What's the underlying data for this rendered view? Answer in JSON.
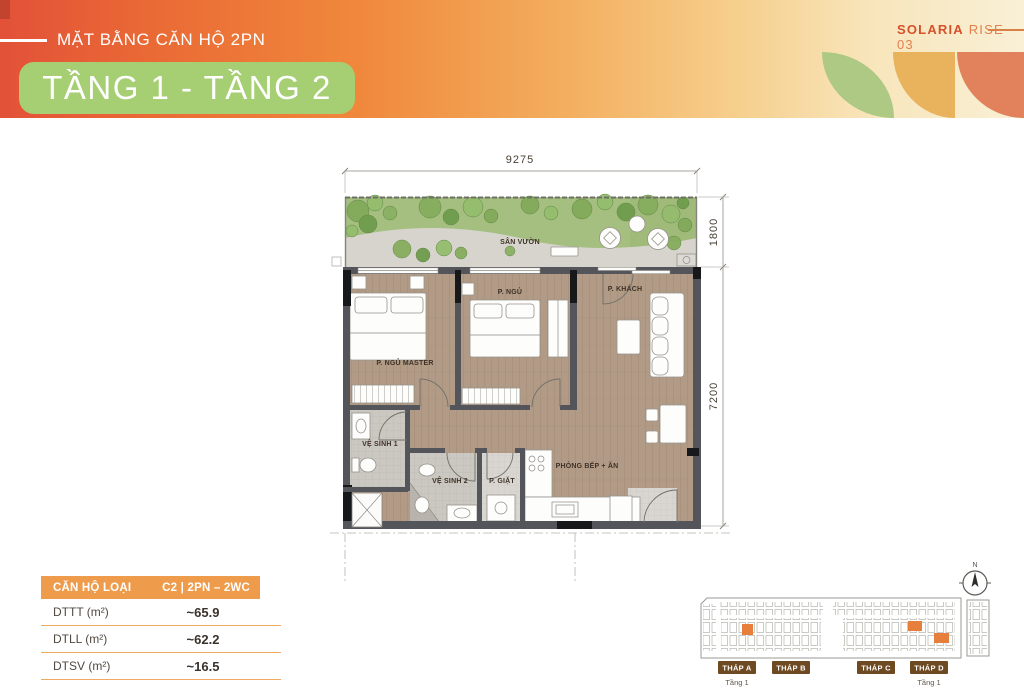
{
  "header": {
    "eyebrow": "MẶT BẰNG CĂN HỘ 2PN",
    "title": "TẦNG 1 - TẦNG 2",
    "brand_name": "SOLARIA",
    "brand_suffix": "RISE – 03"
  },
  "plan": {
    "dimensions": {
      "width_top": "9275",
      "garden_depth": "1800",
      "main_depth": "7200"
    },
    "rooms": {
      "garden": "SÂN VƯỜN",
      "master_bedroom": "P. NGỦ MASTER",
      "bedroom": "P. NGỦ",
      "living": "P. KHÁCH",
      "bathroom1": "VỆ SINH 1",
      "bathroom2": "VỆ SINH 2",
      "laundry": "P. GIẶT",
      "kitchen_dining": "PHÒNG BẾP + ĂN"
    }
  },
  "spec_table": {
    "header_label": "CĂN HỘ LOẠI",
    "header_value": "C2 | 2PN – 2WC",
    "rows": [
      {
        "label": "DTTT (m²)",
        "value": "~65.9"
      },
      {
        "label": "DTLL (m²)",
        "value": "~62.2"
      },
      {
        "label": "DTSV (m²)",
        "value": "~16.5"
      }
    ]
  },
  "site_plan": {
    "compass_label": "N",
    "towers": [
      {
        "label": "THÁP A",
        "sub": "Tầng 1"
      },
      {
        "label": "THÁP B"
      },
      {
        "label": "THÁP C"
      },
      {
        "label": "THÁP D",
        "sub": "Tầng 1"
      }
    ]
  },
  "colors": {
    "accent_orange": "#EF9B4C",
    "badge_green": "#A6CE73",
    "brand_red": "#D6502A",
    "tower_brown": "#6E4A22",
    "unit_highlight": "#E87E3C",
    "wood_floor": "#B29B86"
  }
}
